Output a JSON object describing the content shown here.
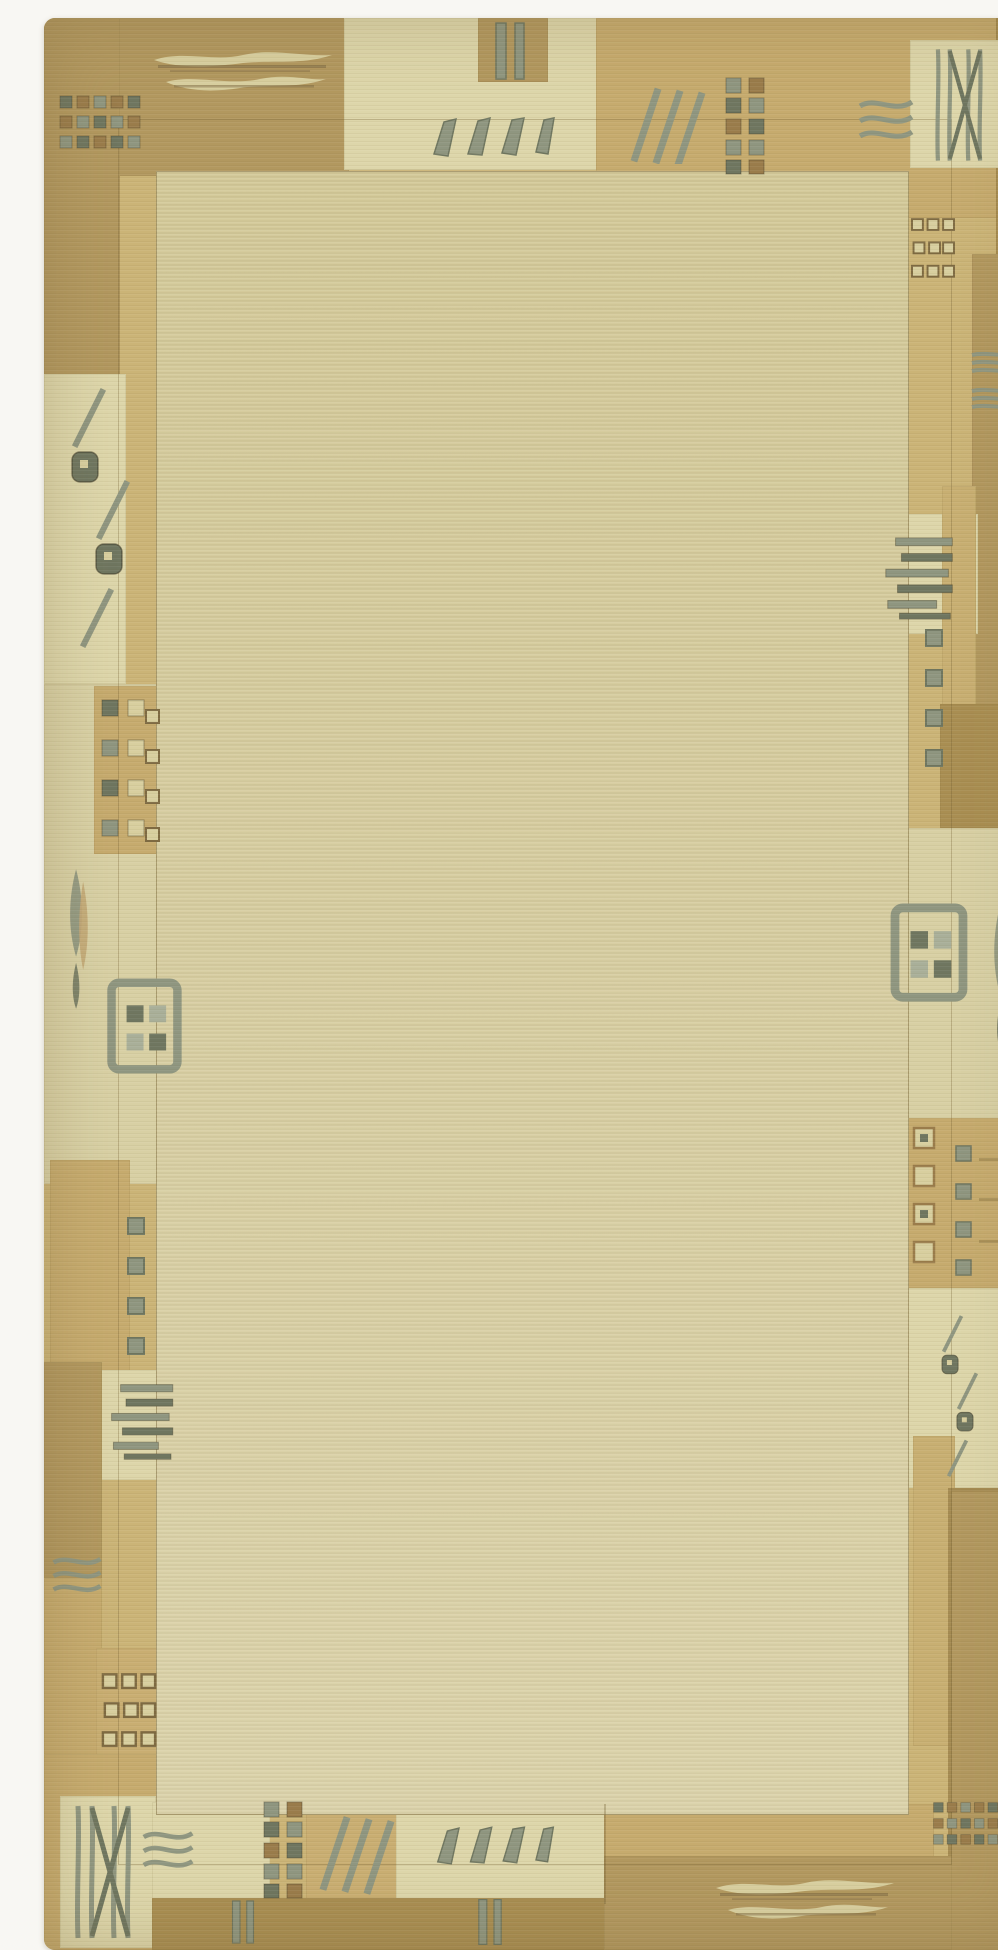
{
  "meta": {
    "type": "photograph",
    "subject": "Hand-knotted Nepali-Tibetan style wool rug, portrait orientation",
    "caption": "Cream wool rug with a patchwork border of tan, gold and beige blocks decorated with sage-grey and brown geometric motifs; plain beige central field framed by a gold inner band.",
    "field_texture": "fine horizontal weave lines",
    "background": "white photo backdrop"
  },
  "palette": {
    "photo_bg": "#f8f7f3",
    "band_gold": "#cbb477",
    "band_gold2": "#c8af72",
    "field": "#d5cb9c",
    "field_light": "#dcd4a8",
    "cream_patch": "#ddd6aa",
    "cream_patch2": "#d8d0a4",
    "tan_medium": "#c6ab6e",
    "tan_medium2": "#c9ae72",
    "tan_dark": "#b2985f",
    "tan_deep": "#a98e52",
    "sage": "#8f9680",
    "sage_dark": "#6f7660",
    "sage_light": "#a9af99",
    "motif_brown": "#9a7c4b",
    "motif_outline": "#7e6a42",
    "cream_motif": "#d8cf9f",
    "leaf_tan": "#c3a877",
    "seam": "rgba(110,90,45,0.30)"
  },
  "motif_inventory": [
    "double-fish bars (top-left, bottom-right)",
    "small squares grid (corners)",
    "outlined squares grid (left edge, right edge)",
    "parallelogram row (top-center, bottom-center)",
    "double vertical bars (top and bottom)",
    "diagonal triple lines (top-right, bottom-left)",
    "two-column dotted squares (top, bottom)",
    "wavy triple lines (top-right, left, bottom-left)",
    "lattice X with vertical bars (top-right corner, bottom-left corner)",
    "stacked horizontal piano bars (left, right)",
    "square window with four panes (left, right)",
    "slash-and-blob diagonal chain (left edge, right edge)",
    "vertical leaf pods (left, right)"
  ]
}
